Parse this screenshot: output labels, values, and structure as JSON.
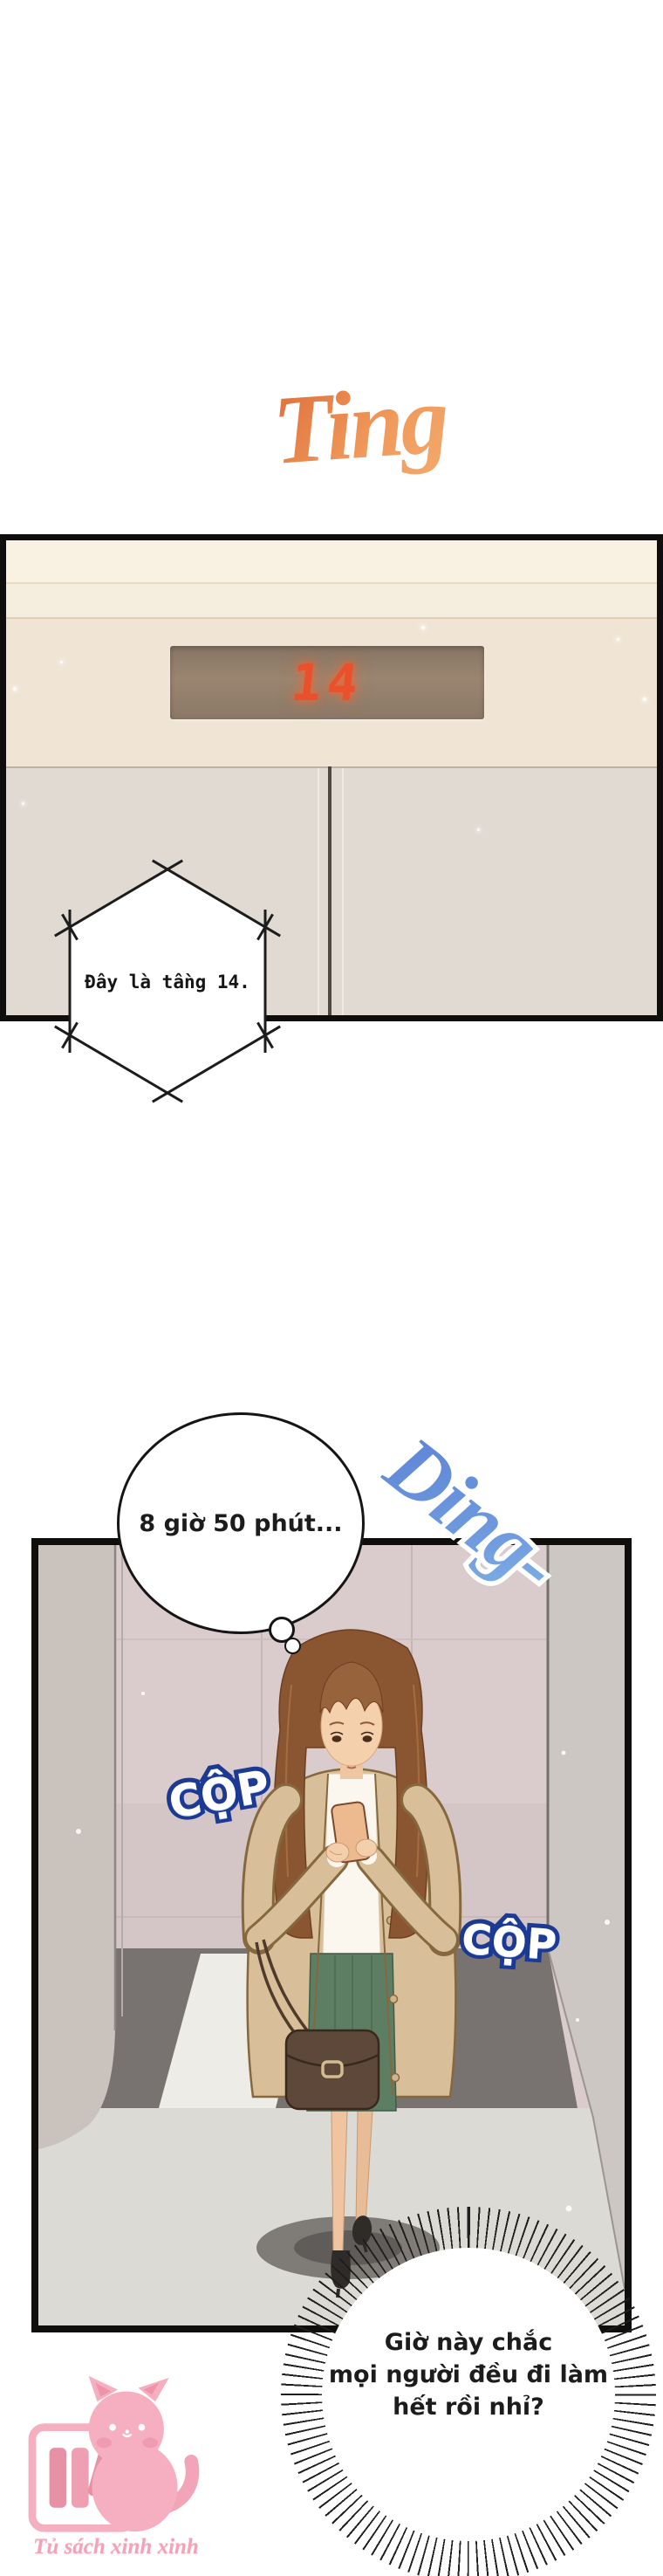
{
  "page_type": "webtoon comic page",
  "sfx": {
    "ting": {
      "text": "Ting",
      "color_from": "#DD6F3A",
      "color_to": "#F3AC70"
    },
    "ding": {
      "text": "Ding-",
      "color_from": "#5D84D6",
      "color_to": "#8CC4EC"
    },
    "cop_left": {
      "text": "CỘP"
    },
    "cop_right": {
      "text": "CỘP"
    },
    "cop_outline_color": "#1C3A94",
    "cop_fill_color": "#FFFFFF"
  },
  "panel1": {
    "description": "elevator hall close-up with floor indicator",
    "display": {
      "value": "14",
      "digit_color": "#E8512C",
      "panel_color": "#9A8570"
    }
  },
  "panel2": {
    "description": "woman standing inside elevator looking at phone"
  },
  "speech": {
    "hex_bubble": {
      "text": "Đây là tầng 14."
    },
    "thought_bubble": {
      "text": "8 giờ 50 phút..."
    },
    "burst_bubble": {
      "lines": [
        "Giờ này chắc",
        "mọi người đều đi làm",
        "hết rồi nhỉ?"
      ]
    }
  },
  "watermark": {
    "text": "Tủ sách xinh xinh",
    "color": "#F2A3B8"
  }
}
